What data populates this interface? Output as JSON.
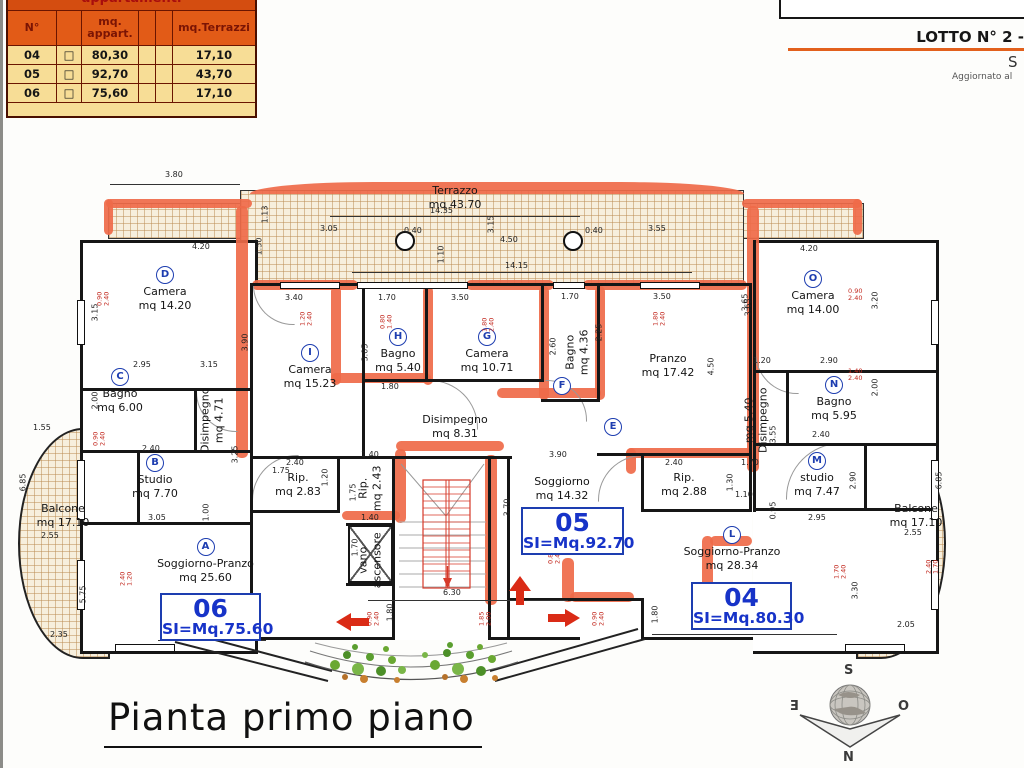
{
  "legend": {
    "title": "appartamenti",
    "headers": [
      "N°",
      "mq.\nappart.",
      "mq.Terrazzi"
    ],
    "checkbox": "□",
    "rows": [
      {
        "n": "04",
        "mq": "80,30",
        "t": "17,10"
      },
      {
        "n": "05",
        "mq": "92,70",
        "t": "43,70"
      },
      {
        "n": "06",
        "mq": "75,60",
        "t": "17,10"
      }
    ]
  },
  "header": {
    "logo": "COSTRUZIONI",
    "lotto": "LOTTO N° 2 -",
    "s": "S",
    "updated": "Aggiornato al"
  },
  "title": "Pianta primo piano",
  "compass": {
    "n": "N",
    "s": "S",
    "e": "E",
    "o": "O"
  },
  "rooms": [
    {
      "letter": "D",
      "name": "Camera",
      "area": "mq 14.20"
    },
    {
      "letter": "C",
      "name": "Bagno",
      "area": "mq 6.00"
    },
    {
      "letter": "B",
      "name": "Studio",
      "area": "mq 7.70"
    },
    {
      "letter": "A",
      "name": "Soggiorno-Pranzo",
      "area": "mq 25.60"
    },
    {
      "letter": "I",
      "name": "Camera",
      "area": "mq 15.23"
    },
    {
      "letter": "H",
      "name": "Bagno",
      "area": "mq 5.40"
    },
    {
      "letter": "G",
      "name": "Camera",
      "area": "mq 10.71"
    },
    {
      "letter": "F",
      "name": "Bagno",
      "area": "mq 4.36"
    },
    {
      "letter": "E",
      "name": "Pranzo",
      "area": "mq 17.42"
    },
    {
      "letter": "",
      "name": "Disimpegno",
      "area": "mq 8.31"
    },
    {
      "letter": "",
      "name": "Disimpegno",
      "area": "mq 4.71"
    },
    {
      "letter": "",
      "name": "Rip.",
      "area": "mq 2.83"
    },
    {
      "letter": "",
      "name": "Rip.",
      "area": "mq 2.43"
    },
    {
      "letter": "",
      "name": "Soggiorno",
      "area": "mq 14.32"
    },
    {
      "letter": "",
      "name": "Rip.",
      "area": "mq 2.88"
    },
    {
      "letter": "",
      "name": "Disimpegno",
      "area": "mq 5.40"
    },
    {
      "letter": "O",
      "name": "Camera",
      "area": "mq 14.00"
    },
    {
      "letter": "N",
      "name": "Bagno",
      "area": "mq 5.95"
    },
    {
      "letter": "M",
      "name": "studio",
      "area": "mq 7.47"
    },
    {
      "letter": "L",
      "name": "Soggiorno-Pranzo",
      "area": "mq 28.34"
    },
    {
      "letter": "",
      "name": "vano",
      "area": "ascensore"
    },
    {
      "letter": "",
      "name": "Terrazzo",
      "area": "mq 43.70"
    },
    {
      "letter": "",
      "name": "Balcone",
      "area": "mq 17.10"
    },
    {
      "letter": "",
      "name": "Balcone",
      "area": "mq 17.10"
    }
  ],
  "apartments": [
    {
      "num": "06",
      "si": "SI=Mq.75.60"
    },
    {
      "num": "05",
      "si": "SI=Mq.92.70"
    },
    {
      "num": "04",
      "si": "SI=Mq.80.30"
    }
  ],
  "dims": [
    "3.80",
    "14.35",
    "3.05",
    "0.40",
    "0.40",
    "3.55",
    "3.15",
    "4.50",
    "1.10",
    "14.15",
    "1.13",
    "1.50",
    "4.20",
    "3.90",
    "3.15",
    "2.95",
    "3.15",
    "2.00",
    "2.40",
    "3.25",
    "1.75",
    "3.05",
    "1.00",
    "6.80",
    "1.55",
    "6.85",
    "2.55",
    "5.75",
    "2.35",
    "3.40",
    "1.70",
    "3.50",
    "1.70",
    "3.50",
    "3.05",
    "1.80",
    "2.25",
    "2.60",
    "4.50",
    "3.65",
    "2.40",
    "1.40",
    "1.20",
    "1.75",
    "1.40",
    "1.70",
    "3.90",
    "3.70",
    "6.30",
    "1.80",
    "1.80",
    "2.40",
    "1.70",
    "1.30",
    "1.10",
    "0.95",
    "8.70",
    "4.20",
    "3.65",
    "3.20",
    "1.20",
    "2.90",
    "2.00",
    "2.40",
    "3.55",
    "2.95",
    "2.90",
    "3.30",
    "6.85",
    "2.55",
    "2.05"
  ],
  "red_dims": [
    "0.90\n2.40",
    "0.90\n2.40",
    "2.40\n1.20",
    "1.20\n2.40",
    "0.80\n1.40",
    "1.80\n2.40",
    "1.80\n2.40",
    "0.90\n2.40",
    "1.40\n2.40",
    "0.90\n2.40",
    "1.85\n2.00",
    "0.90\n2.40",
    "1.70\n2.40",
    "0.80\n2.40",
    "2.40\n1.70"
  ]
}
